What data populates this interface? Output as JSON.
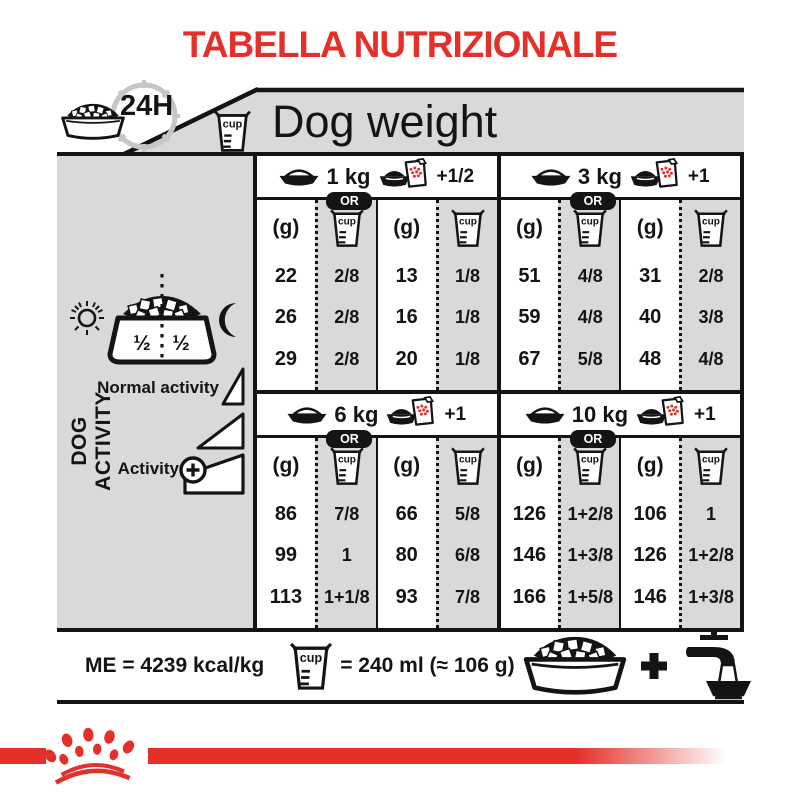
{
  "title": "TABELLA NUTRIZIONALE",
  "colors": {
    "red": "#e4302a",
    "gray": "#d9d9d9",
    "black": "#141414"
  },
  "header": {
    "duration": "24H",
    "dog_weight": "Dog weight"
  },
  "table": {
    "or_label": "OR",
    "grams_label": "(g)",
    "cup_label": "cup",
    "weights": [
      {
        "weight": "1 kg",
        "extra": "+1/2",
        "bowl": {
          "rows": [
            {
              "g": "22",
              "cup": "2/8"
            },
            {
              "g": "26",
              "cup": "2/8"
            },
            {
              "g": "29",
              "cup": "2/8"
            }
          ]
        },
        "pouch": {
          "rows": [
            {
              "g": "13",
              "cup": "1/8"
            },
            {
              "g": "16",
              "cup": "1/8"
            },
            {
              "g": "20",
              "cup": "1/8"
            }
          ]
        }
      },
      {
        "weight": "3 kg",
        "extra": "+1",
        "bowl": {
          "rows": [
            {
              "g": "51",
              "cup": "4/8"
            },
            {
              "g": "59",
              "cup": "4/8"
            },
            {
              "g": "67",
              "cup": "5/8"
            }
          ]
        },
        "pouch": {
          "rows": [
            {
              "g": "31",
              "cup": "2/8"
            },
            {
              "g": "40",
              "cup": "3/8"
            },
            {
              "g": "48",
              "cup": "4/8"
            }
          ]
        }
      },
      {
        "weight": "6 kg",
        "extra": "+1",
        "bowl": {
          "rows": [
            {
              "g": "86",
              "cup": "7/8"
            },
            {
              "g": "99",
              "cup": "1"
            },
            {
              "g": "113",
              "cup": "1+1/8"
            }
          ]
        },
        "pouch": {
          "rows": [
            {
              "g": "66",
              "cup": "5/8"
            },
            {
              "g": "80",
              "cup": "6/8"
            },
            {
              "g": "93",
              "cup": "7/8"
            }
          ]
        }
      },
      {
        "weight": "10 kg",
        "extra": "+1",
        "bowl": {
          "rows": [
            {
              "g": "126",
              "cup": "1+2/8"
            },
            {
              "g": "146",
              "cup": "1+3/8"
            },
            {
              "g": "166",
              "cup": "1+5/8"
            }
          ]
        },
        "pouch": {
          "rows": [
            {
              "g": "106",
              "cup": "1"
            },
            {
              "g": "126",
              "cup": "1+2/8"
            },
            {
              "g": "146",
              "cup": "1+3/8"
            }
          ]
        }
      }
    ]
  },
  "sidebar": {
    "title": "DOG ACTIVITY",
    "portion_left": "½",
    "portion_right": "½",
    "normal_label": "Normal activity",
    "active_label": "Activity"
  },
  "footer": {
    "me": "ME = 4239 kcal/kg",
    "cup_equiv": "= 240 ml (≈ 106 g)"
  }
}
